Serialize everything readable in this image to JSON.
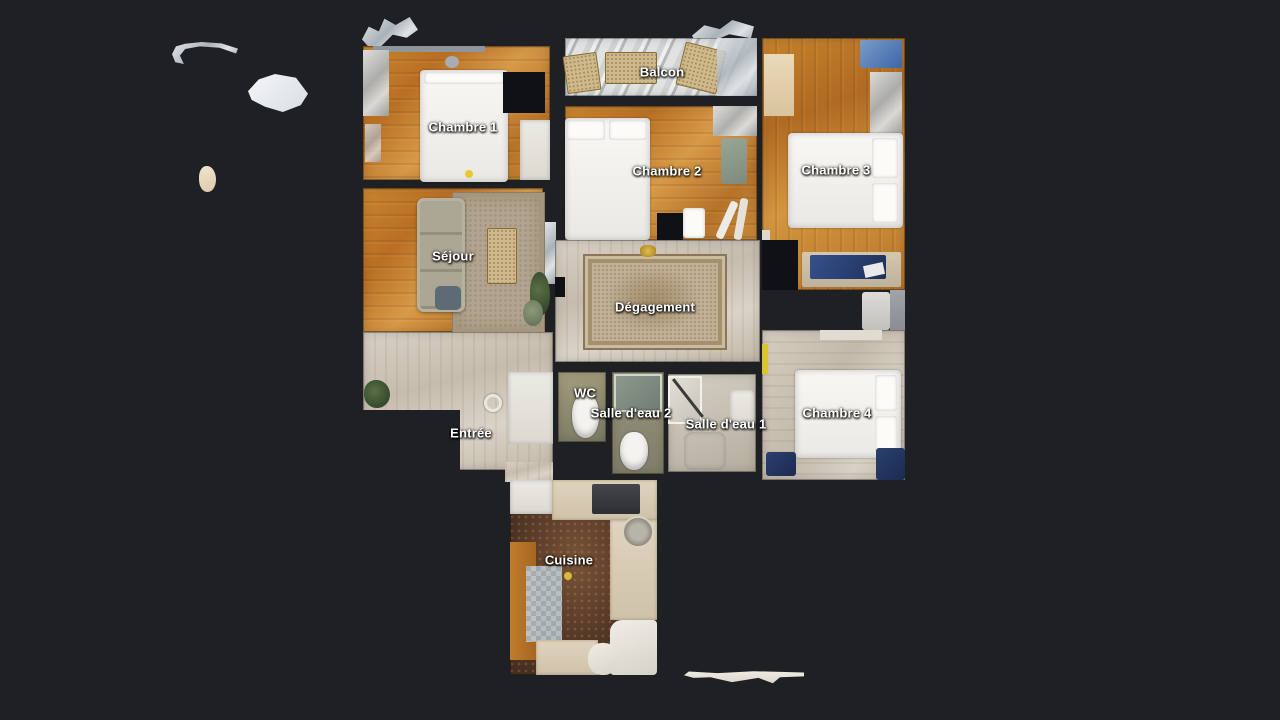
{
  "app": {
    "view_name": "floorplan",
    "background_color": "#1e2023",
    "label_text_color": "#ffffff"
  },
  "floorplan": {
    "rooms": [
      {
        "label": "Balcon"
      },
      {
        "label": "Chambre 1"
      },
      {
        "label": "Chambre 2"
      },
      {
        "label": "Chambre 3"
      },
      {
        "label": "Séjour"
      },
      {
        "label": "Dégagement"
      },
      {
        "label": "Chambre 4"
      },
      {
        "label": "Entrée"
      },
      {
        "label": "WC"
      },
      {
        "label": "Salle d'eau 2"
      },
      {
        "label": "Salle d'eau 1"
      },
      {
        "label": "Cuisine"
      }
    ]
  }
}
